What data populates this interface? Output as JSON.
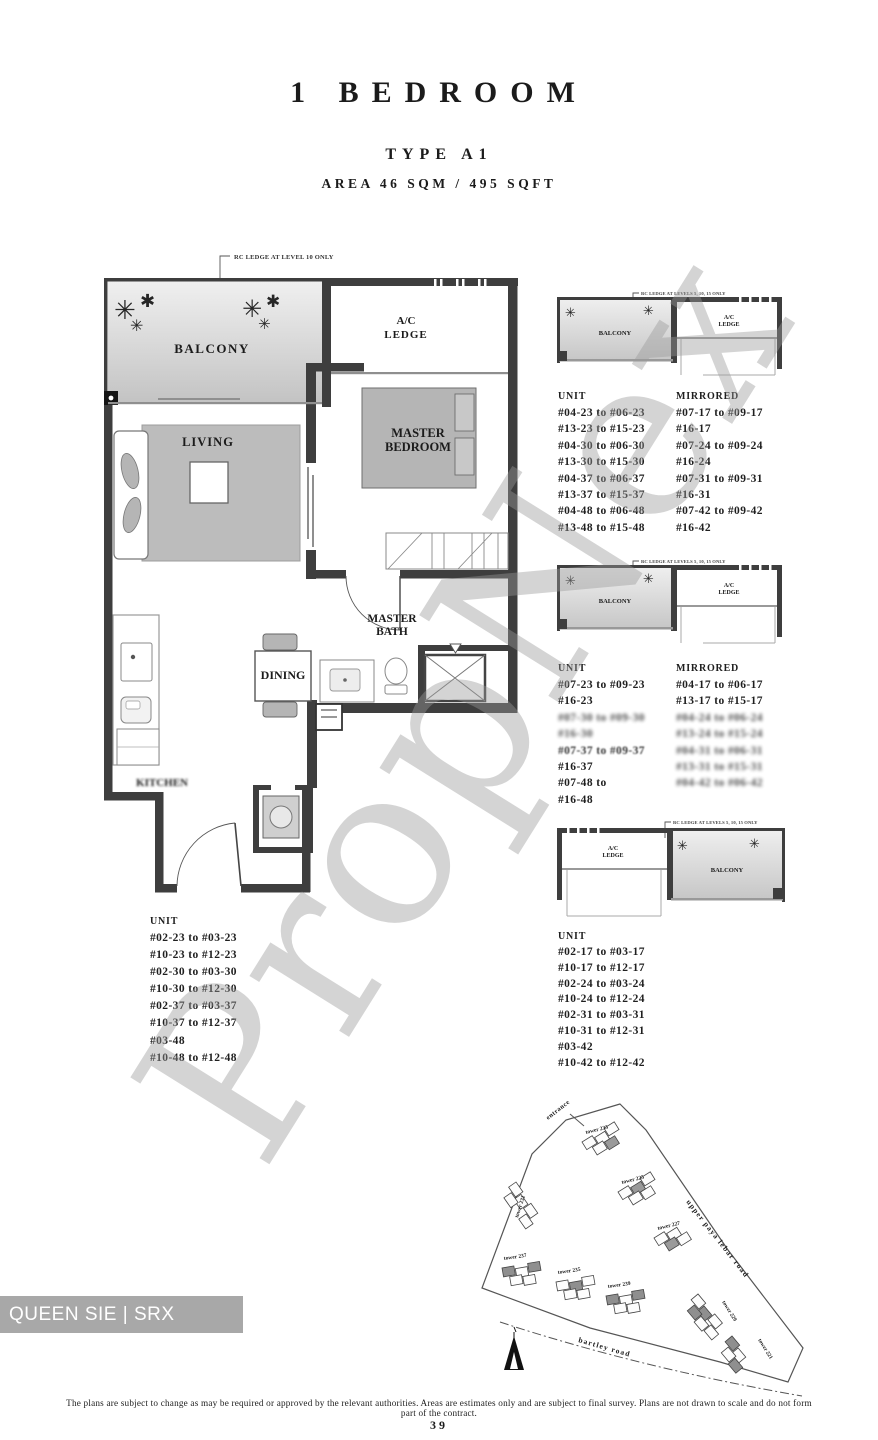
{
  "title": {
    "category": "1 BEDROOM",
    "type": "TYPE A1",
    "area": "AREA 46 SQM / 495 SQFT"
  },
  "floor_plan": {
    "annotation": "RC LEDGE AT LEVEL 10 ONLY",
    "rooms": {
      "balcony": "BALCONY",
      "ac_ledge_line1": "A/C",
      "ac_ledge_line2": "LEDGE",
      "living": "LIVING",
      "master_bedroom_line1": "MASTER",
      "master_bedroom_line2": "BEDROOM",
      "master_bath_line1": "MASTER",
      "master_bath_line2": "BATH",
      "dining": "DINING",
      "kitchen": "KITCHEN"
    }
  },
  "stacks": [
    {
      "annotation": "RC LEDGE AT LEVELS 5, 10, 15 ONLY",
      "diagram_labels": {
        "balcony": "BALCONY",
        "ac_ledge_line1": "A/C",
        "ac_ledge_line2": "LEDGE"
      },
      "unit_header": "UNIT",
      "mirrored_header": "MIRRORED",
      "unit_rows": [
        "#04-23 to #06-23",
        "#13-23 to #15-23",
        "#04-30 to #06-30",
        "#13-30 to #15-30",
        "#04-37 to #06-37",
        "#13-37 to #15-37",
        "#04-48 to #06-48",
        "#13-48 to #15-48"
      ],
      "mirrored_rows": [
        "#07-17 to #09-17",
        "#16-17",
        "#07-24 to #09-24",
        "#16-24",
        "#07-31 to #09-31",
        "#16-31",
        "#07-42 to #09-42",
        "#16-42"
      ]
    },
    {
      "annotation": "RC LEDGE AT LEVELS 5, 10, 15 ONLY",
      "diagram_labels": {
        "balcony": "BALCONY",
        "ac_ledge_line1": "A/C",
        "ac_ledge_line2": "LEDGE"
      },
      "unit_header": "UNIT",
      "mirrored_header": "MIRRORED",
      "unit_rows": [
        "#07-23 to #09-23",
        "#16-23",
        "#07-30 to #09-30",
        "#16-30",
        "#07-37 to #09-37",
        "#16-37",
        "#07-48 to",
        "#16-48"
      ],
      "mirrored_rows": [
        "#04-17 to #06-17",
        "#13-17 to #15-17",
        "#04-24 to #06-24",
        "#13-24 to #15-24",
        "#04-31 to #06-31",
        "#13-31 to #15-31",
        "#04-42 to #06-42"
      ]
    },
    {
      "annotation": "RC LEDGE AT LEVELS 5, 10, 15 ONLY",
      "diagram_labels": {
        "balcony": "BALCONY",
        "ac_ledge_line1": "A/C",
        "ac_ledge_line2": "LEDGE"
      },
      "unit_header": "UNIT",
      "unit_rows": [
        "#02-17 to #03-17",
        "#10-17 to #12-17",
        "#02-24 to #03-24",
        "#10-24 to #12-24",
        "#02-31 to #03-31",
        "#10-31 to #12-31",
        "#03-42",
        "#10-42 to #12-42"
      ]
    }
  ],
  "left_unit_list": {
    "header": "UNIT",
    "rows": [
      "#02-23 to #03-23",
      "#10-23 to #12-23",
      "#02-30 to #03-30",
      "#10-30 to #12-30",
      "#02-37 to #03-37",
      "#10-37 to #12-37",
      "#03-48",
      "#10-48 to #12-48"
    ]
  },
  "site_plan": {
    "entrance_label": "entrance",
    "road_top": "upper paya lebar road",
    "road_bottom": "bartley road",
    "towers": [
      "tower 233",
      "tower 225",
      "tower 227",
      "tower 231",
      "tower 237",
      "tower 235",
      "tower 239",
      "tower 229",
      "tower 221"
    ]
  },
  "watermark": {
    "diagonal_text": "PropNex",
    "agent_badge": "QUEEN SIE | SRX PROPERTY"
  },
  "footer": {
    "disclaimer": "The plans are subject to change as may be required or approved by the relevant authorities. Areas are estimates only and are subject to final survey. Plans are not drawn to scale and do not form part of the contract.",
    "page_number": "39"
  },
  "colors": {
    "wall": "#3e3e3e",
    "furniture": "#b5b5b5",
    "watermark": "#9a9a9a",
    "badge_bg": "#a8a8a8"
  }
}
